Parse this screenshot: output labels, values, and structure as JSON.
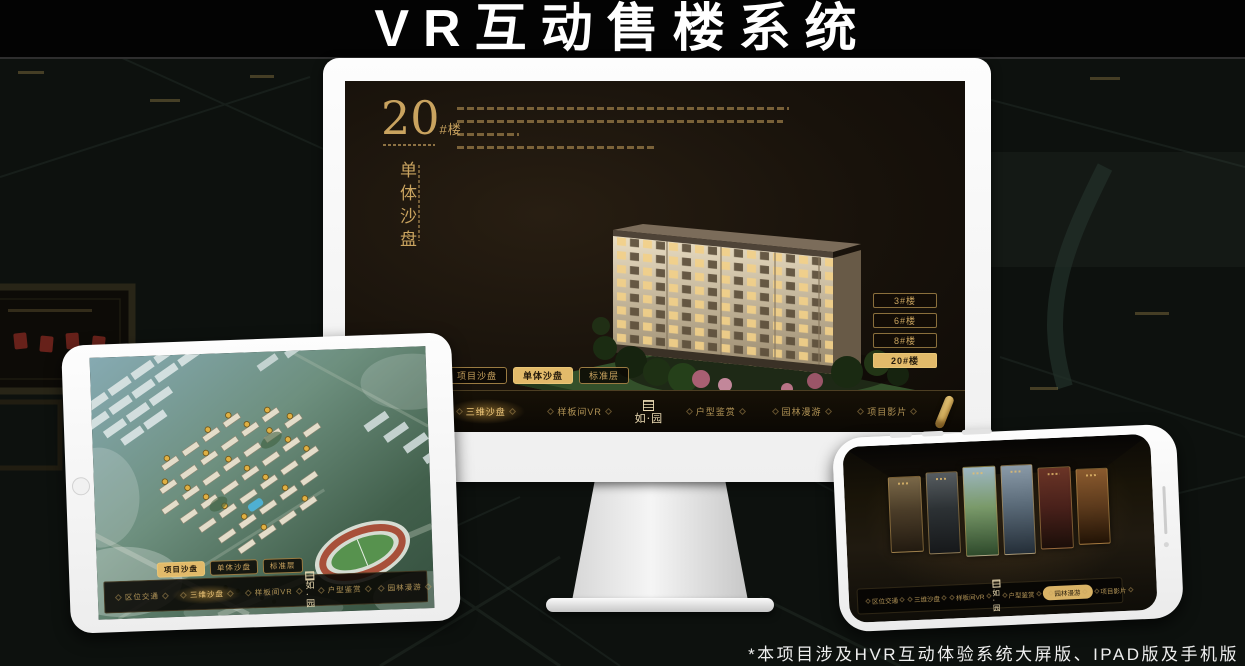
{
  "title": "VR互动售楼系统",
  "footnote": "*本项目涉及HVR互动体验系统大屏版、IPAD版及手机版",
  "brand": {
    "logo": "如·园"
  },
  "nav": {
    "items": [
      "区位交通",
      "三维沙盘",
      "样板间VR",
      "户型鉴赏",
      "园林漫游",
      "项目影片"
    ]
  },
  "tabs": [
    "项目沙盘",
    "单体沙盘",
    "标准层"
  ],
  "monitor": {
    "headline_number": "20",
    "headline_unit": "#楼",
    "headline_subtitle": "单体沙盘",
    "building_buttons": [
      "3#楼",
      "6#楼",
      "8#楼",
      "20#楼"
    ]
  },
  "colors": {
    "gold": "#c9a35f",
    "gold_active": "#e2ba6a",
    "background": "#0c100d"
  }
}
